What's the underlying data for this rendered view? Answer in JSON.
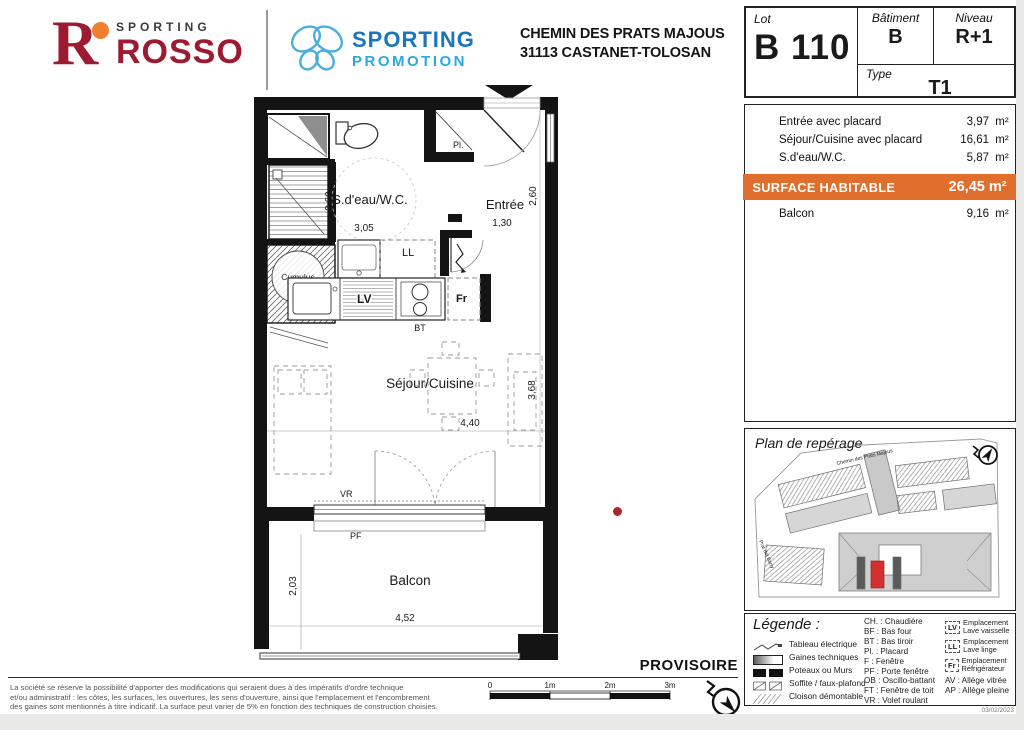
{
  "header": {
    "rosso": {
      "sporting": "SPORTING",
      "name": "ROSSO",
      "r": "R"
    },
    "promotion": {
      "line1": "SPORTING",
      "line2": "PROMOTION"
    },
    "address_line1": "CHEMIN DES PRATS MAJOUS",
    "address_line2": "31113 CASTANET-TOLOSAN"
  },
  "lot": {
    "lot_label": "Lot",
    "lot_value": "B 110",
    "batiment_label": "Bâtiment",
    "batiment_value": "B",
    "niveau_label": "Niveau",
    "niveau_value": "R+1",
    "type_label": "Type",
    "type_value": "T1"
  },
  "areas": {
    "rows": [
      {
        "label": "Entrée avec placard",
        "value": "3,97",
        "unit": "m²"
      },
      {
        "label": "Séjour/Cuisine avec placard",
        "value": "16,61",
        "unit": "m²"
      },
      {
        "label": "S.d'eau/W.C.",
        "value": "5,87",
        "unit": "m²"
      }
    ],
    "surface": {
      "label": "SURFACE HABITABLE",
      "value": "26,45 m²"
    },
    "balcon": {
      "label": "Balcon",
      "value": "9,16",
      "unit": "m²"
    }
  },
  "plan": {
    "unit": "B110",
    "rooms": {
      "sdeau": "S.d'eau/W.C.",
      "entree": "Entrée",
      "sejour": "Séjour/Cuisine",
      "balcon": "Balcon"
    },
    "dims": {
      "sdeau_h": "2,60",
      "sdeau_w": "3,05",
      "entree_w": "1,30",
      "entree_h": "2,60",
      "sejour_w": "4,40",
      "sejour_h": "3,68",
      "balcon_h": "2,03",
      "balcon_w": "4,52"
    },
    "tags": {
      "cumulus": "Cumulus",
      "pl_cumulus": "Pl.",
      "pl_entree": "Pl.",
      "ll": "LL",
      "lv": "LV",
      "fr": "Fr",
      "bt": "BT",
      "vr": "VR",
      "pf": "PF"
    }
  },
  "reperage": {
    "title": "Plan de repérage",
    "street1": "Chemin des Prats Majous",
    "street2": "Prat del Barry"
  },
  "legend": {
    "title": "Légende :",
    "symbols": [
      {
        "label": "Tableau électrique"
      },
      {
        "label": "Gaines techniques"
      },
      {
        "label": "Poteaux ou Murs"
      },
      {
        "label": "Soffite / faux-plafond"
      },
      {
        "label": "Cloison démontable"
      }
    ],
    "abbreviations": [
      "CH. : Chaudière",
      "BF : Bas four",
      "BT : Bas tiroir",
      "Pl. : Placard",
      "F : Fenêtre",
      "PF : Porte fenêtre",
      "OB : Oscillo-battant",
      "FT : Fenêtre de toit",
      "VR : Volet roulant"
    ],
    "equipment": [
      {
        "badge": "LV",
        "line1": "Emplacement",
        "line2": "Lave vaisselle"
      },
      {
        "badge": "LL",
        "line1": "Emplacement",
        "line2": "Lave linge"
      },
      {
        "badge": "Fr",
        "line1": "Emplacement",
        "line2": "Réfrigérateur"
      }
    ],
    "alleges": [
      "AV : Allège vitrée",
      "AP : Allège pleine"
    ]
  },
  "footer": {
    "disclaimer_l1": "La société se réserve la possibilité d'apporter des modifications qui seraient dues à des impératifs d'ordre technique",
    "disclaimer_l2": "et/ou administratif : les côtes, les surfaces, les ouvertures, les sens d'ouverture, ainsi que l'emplacement et l'encombrement",
    "disclaimer_l3": "des gaines sont mentionnés à titre indicatif. La surface peut varier de 5% en fonction des techniques de construction choisies.",
    "provisoire": "PROVISOIRE",
    "scale_ticks": [
      "0",
      "1m",
      "2m",
      "3m"
    ],
    "date": "03/02/2023"
  },
  "colors": {
    "accent_orange": "#e06f2e",
    "rosso_red": "#9c1b30",
    "rosso_orange": "#f0802f",
    "promo_blue": "#1b75bb",
    "promo_light_blue": "#2aa9e0",
    "highlight_red": "#d03030",
    "wall_black": "#141414"
  }
}
